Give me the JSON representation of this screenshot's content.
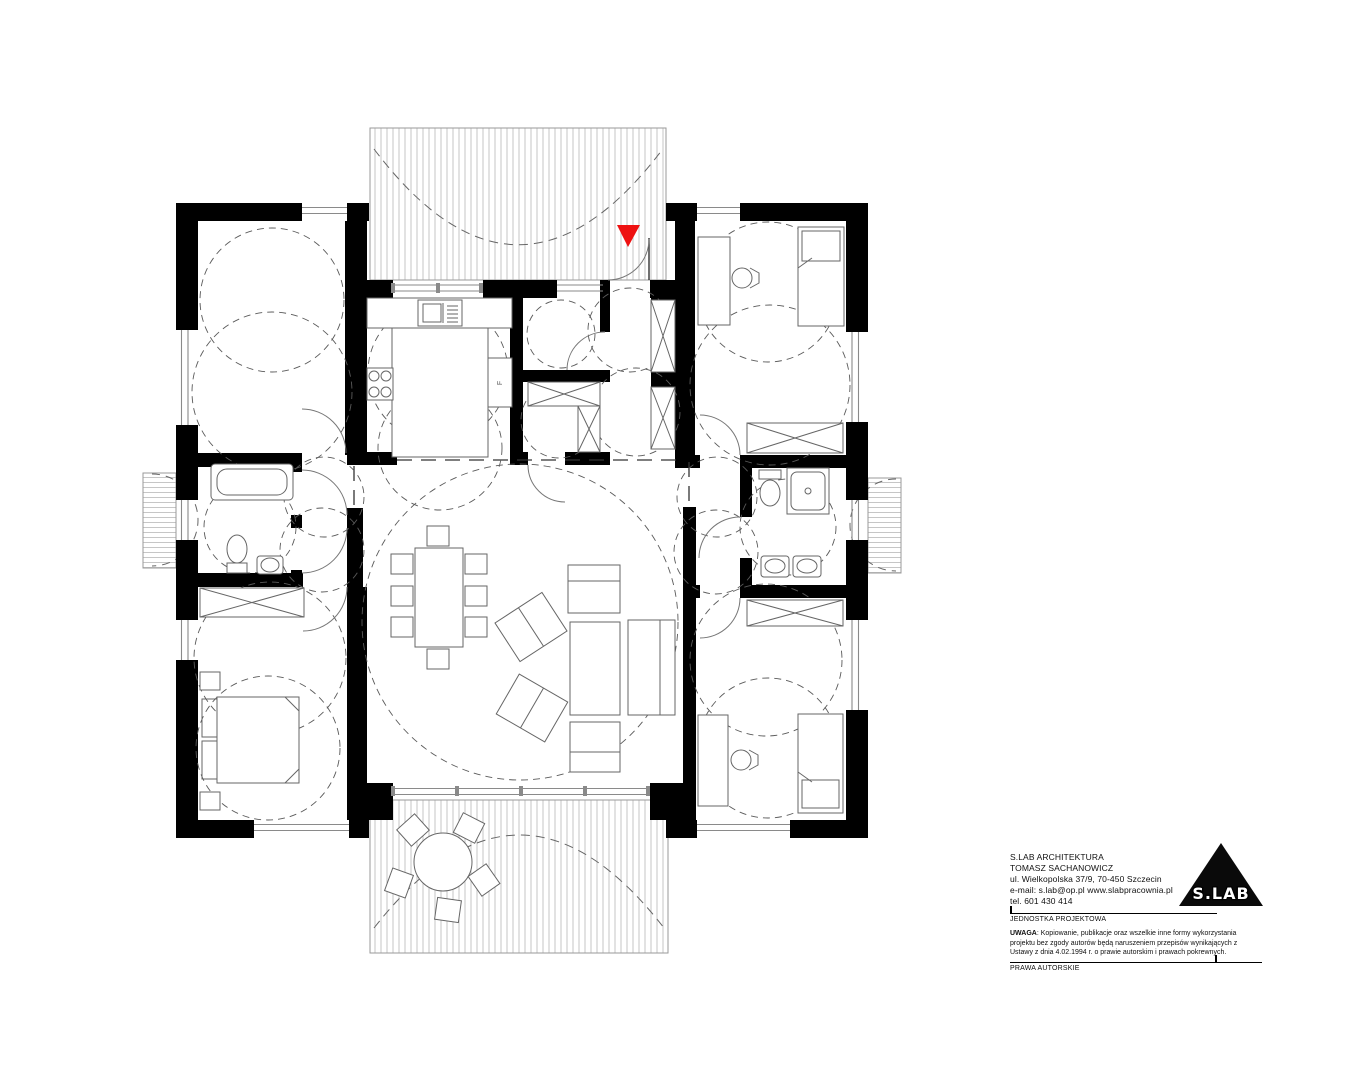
{
  "titleblock": {
    "company": "S.LAB ARCHITEKTURA",
    "architect": "TOMASZ SACHANOWICZ",
    "address": "ul. Wielkopolska 37/9,  70-450 Szczecin",
    "email_web": "e-mail: s.lab@op.pl   www.slabpracownia.pl",
    "phone": "tel. 601 430 414",
    "unit_label": "JEDNOSTKA PROJEKTOWA",
    "notice_label": "UWAGA",
    "notice_text": ": Kopiowanie, publikacje oraz wszelkie inne formy wykorzystania projektu bez zgody autorów będą naruszeniem przepisów wynikających z Ustawy z dnia 4.02.1994 r. o prawie autorskim i prawach pokrewnych.",
    "rights_label": "PRAWA AUTORSKIE",
    "logo_text": "S.LAB"
  },
  "plan": {
    "fridge_label": "F",
    "colors": {
      "wall": "#000000",
      "entrance_marker": "#ee1111",
      "hatch_line": "#c6c6c6",
      "dash": "#555555"
    }
  }
}
